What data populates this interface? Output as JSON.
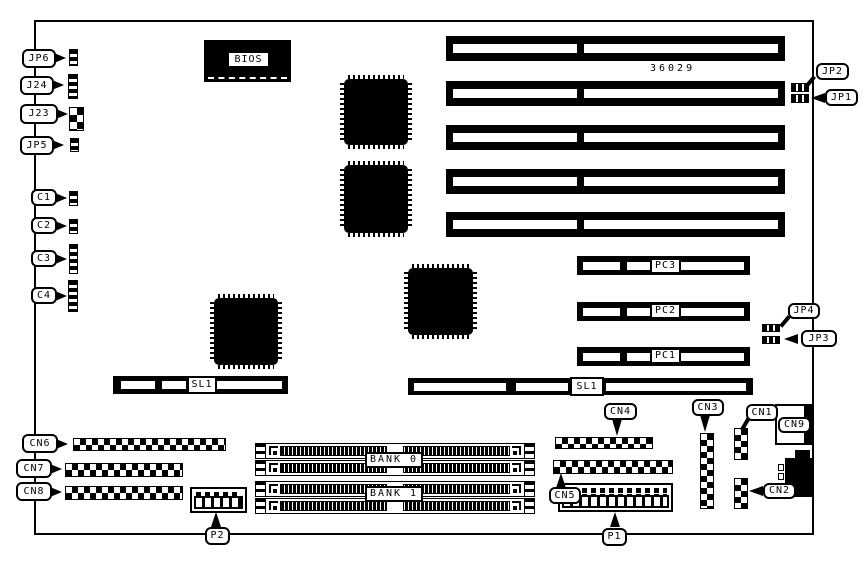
{
  "diagram": {
    "part_number": "36029",
    "bios": "BIOS"
  },
  "labels": {
    "jp6": "JP6",
    "j24": "J24",
    "j23": "J23",
    "jp5": "JP5",
    "c1": "C1",
    "c2": "C2",
    "c3": "C3",
    "c4": "C4",
    "cn1": "CN1",
    "cn2": "CN2",
    "cn3": "CN3",
    "cn4": "CN4",
    "cn5": "CN5",
    "cn6": "CN6",
    "cn7": "CN7",
    "cn8": "CN8",
    "cn9": "CN9",
    "jp1": "JP1",
    "jp2": "JP2",
    "jp3": "JP3",
    "jp4": "JP4",
    "p1": "P1",
    "p2": "P2",
    "pc1": "PC1",
    "pc2": "PC2",
    "pc3": "PC3",
    "sl1_left": "SL1",
    "sl1_right": "SL1",
    "bank0": "BANK 0",
    "bank1": "BANK 1"
  }
}
